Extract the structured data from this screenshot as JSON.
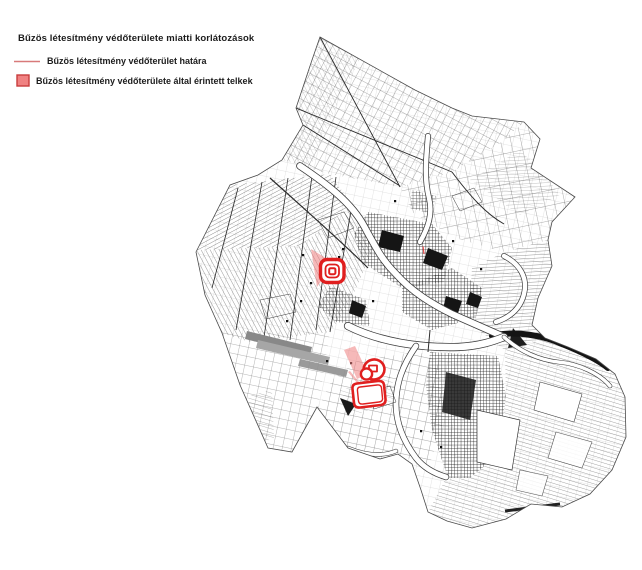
{
  "legend": {
    "title": "Bűzös létesítmény védőterülete miatti korlátozások",
    "items": [
      {
        "type": "line",
        "label": "Bűzös létesítmény védőterület határa",
        "color": "#d87a7a"
      },
      {
        "type": "square",
        "label": "Bűzös létesítmény védőterülete által érintett telkek",
        "fill": "#f08282",
        "border": "#c83c3c"
      }
    ]
  },
  "map": {
    "accent_red": "#e01f1f",
    "highlight_pink": "#ee8080",
    "ink": "#2e2e2e"
  }
}
